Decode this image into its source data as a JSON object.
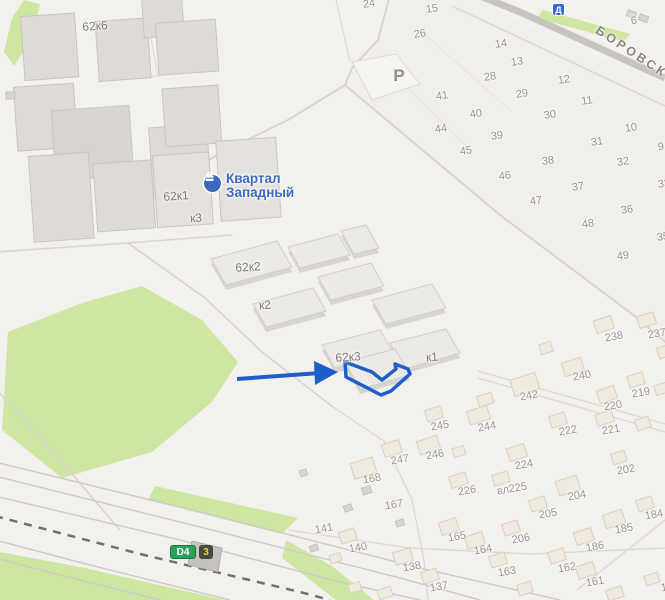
{
  "map": {
    "complex": {
      "line1": "Квартал",
      "line2": "Западный"
    },
    "road_label": "БОРОВСКОЕ",
    "parking_mark": "Р",
    "badges": {
      "metro_diameter": "Д",
      "highway": "D4",
      "highway_exit": "3"
    },
    "colors": {
      "accent_blue": "#1e5ec9",
      "label_blue": "#3c69be",
      "park_green": "#cde7a2",
      "badge_green": "#2fa05a",
      "metro_blue": "#2f6ad1"
    },
    "building_labels": [
      {
        "t": "62к6",
        "x": 95,
        "y": 26
      },
      {
        "t": "62к1",
        "x": 176,
        "y": 196
      },
      {
        "t": "к3",
        "x": 196,
        "y": 218
      },
      {
        "t": "62к2",
        "x": 248,
        "y": 267
      },
      {
        "t": "к2",
        "x": 265,
        "y": 305
      },
      {
        "t": "62к3",
        "x": 348,
        "y": 357
      },
      {
        "t": "к1",
        "x": 432,
        "y": 357
      }
    ],
    "lot_numbers": [
      {
        "t": "24",
        "x": 369,
        "y": 4
      },
      {
        "t": "15",
        "x": 432,
        "y": 9
      },
      {
        "t": "26",
        "x": 420,
        "y": 34
      },
      {
        "t": "6",
        "x": 634,
        "y": 21
      },
      {
        "t": "14",
        "x": 501,
        "y": 44
      },
      {
        "t": "13",
        "x": 517,
        "y": 62
      },
      {
        "t": "28",
        "x": 490,
        "y": 77
      },
      {
        "t": "12",
        "x": 564,
        "y": 80
      },
      {
        "t": "29",
        "x": 522,
        "y": 94
      },
      {
        "t": "11",
        "x": 587,
        "y": 101
      },
      {
        "t": "41",
        "x": 442,
        "y": 96
      },
      {
        "t": "30",
        "x": 550,
        "y": 115
      },
      {
        "t": "40",
        "x": 476,
        "y": 114
      },
      {
        "t": "10",
        "x": 631,
        "y": 128
      },
      {
        "t": "44",
        "x": 441,
        "y": 129
      },
      {
        "t": "39",
        "x": 497,
        "y": 136
      },
      {
        "t": "31",
        "x": 597,
        "y": 142
      },
      {
        "t": "9",
        "x": 661,
        "y": 147
      },
      {
        "t": "45",
        "x": 466,
        "y": 151
      },
      {
        "t": "38",
        "x": 548,
        "y": 161
      },
      {
        "t": "32",
        "x": 623,
        "y": 162
      },
      {
        "t": "46",
        "x": 505,
        "y": 176
      },
      {
        "t": "33",
        "x": 664,
        "y": 184
      },
      {
        "t": "37",
        "x": 578,
        "y": 187
      },
      {
        "t": "47",
        "x": 536,
        "y": 201
      },
      {
        "t": "36",
        "x": 627,
        "y": 210
      },
      {
        "t": "48",
        "x": 588,
        "y": 224
      },
      {
        "t": "35",
        "x": 663,
        "y": 237
      },
      {
        "t": "49",
        "x": 623,
        "y": 256
      }
    ],
    "house_numbers": [
      {
        "t": "238",
        "x": 614,
        "y": 337
      },
      {
        "t": "237",
        "x": 657,
        "y": 334
      },
      {
        "t": "240",
        "x": 582,
        "y": 376
      },
      {
        "t": "242",
        "x": 529,
        "y": 396
      },
      {
        "t": "219",
        "x": 641,
        "y": 393
      },
      {
        "t": "220",
        "x": 613,
        "y": 406
      },
      {
        "t": "222",
        "x": 568,
        "y": 431
      },
      {
        "t": "221",
        "x": 611,
        "y": 430
      },
      {
        "t": "245",
        "x": 440,
        "y": 426
      },
      {
        "t": "244",
        "x": 487,
        "y": 427
      },
      {
        "t": "247",
        "x": 400,
        "y": 460
      },
      {
        "t": "246",
        "x": 435,
        "y": 455
      },
      {
        "t": "224",
        "x": 524,
        "y": 465
      },
      {
        "t": "202",
        "x": 626,
        "y": 470
      },
      {
        "t": "вл225",
        "x": 512,
        "y": 489
      },
      {
        "t": "226",
        "x": 467,
        "y": 491
      },
      {
        "t": "168",
        "x": 372,
        "y": 479
      },
      {
        "t": "167",
        "x": 394,
        "y": 505
      },
      {
        "t": "204",
        "x": 577,
        "y": 496
      },
      {
        "t": "205",
        "x": 548,
        "y": 514
      },
      {
        "t": "206",
        "x": 521,
        "y": 539
      },
      {
        "t": "184",
        "x": 654,
        "y": 515
      },
      {
        "t": "185",
        "x": 624,
        "y": 529
      },
      {
        "t": "186",
        "x": 595,
        "y": 547
      },
      {
        "t": "141",
        "x": 324,
        "y": 529
      },
      {
        "t": "140",
        "x": 358,
        "y": 548
      },
      {
        "t": "165",
        "x": 457,
        "y": 537
      },
      {
        "t": "164",
        "x": 483,
        "y": 550
      },
      {
        "t": "138",
        "x": 412,
        "y": 567
      },
      {
        "t": "137",
        "x": 439,
        "y": 587
      },
      {
        "t": "163",
        "x": 507,
        "y": 572
      },
      {
        "t": "162",
        "x": 567,
        "y": 568
      },
      {
        "t": "161",
        "x": 595,
        "y": 582
      },
      {
        "t": "1",
        "x": 664,
        "y": 588
      }
    ]
  }
}
